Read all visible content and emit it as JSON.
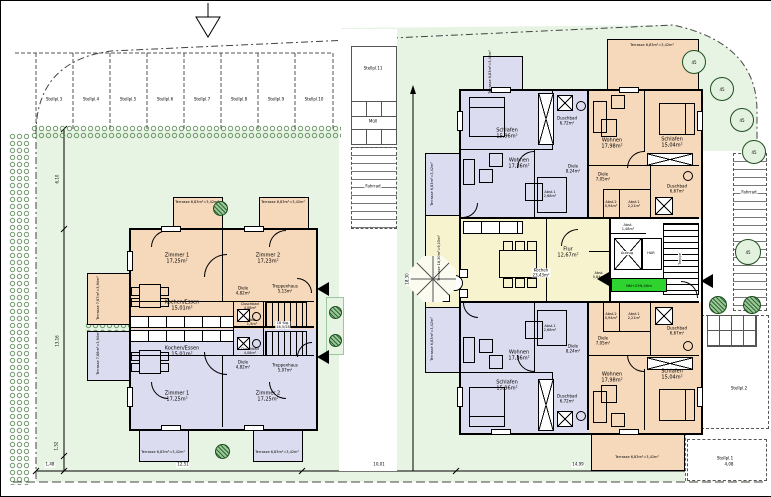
{
  "site": {
    "parking_row": [
      "Stellpl.3",
      "Stellpl.4",
      "Stellpl.5",
      "Stellpl.6",
      "Stellpl.7",
      "Stellpl.8",
      "Stellpl.9",
      "Stellpl.10"
    ],
    "stellpl11": "Stellpl.11",
    "stellpl2": "Stellpl.2",
    "stellpl1": "Stellpl.1",
    "muell": "Müll",
    "fahrrad_left": "Fahrrad",
    "fahrrad_right": "Fahrrad",
    "tree_label": "45",
    "elevation": "NN+259,40m"
  },
  "dims": {
    "b1": "1,48",
    "b2": "12,51",
    "b3": "10,01",
    "b4": "14,99",
    "b5": "4,08",
    "l1": "6,10",
    "l2": "13,16",
    "l3": "1,52",
    "m1": "18,30"
  },
  "house1": {
    "upper": {
      "zimmer1": "Zimmer 1\n17,25m²",
      "zimmer2": "Zimmer 2\n17,23m²",
      "kochen": "Kochen/Essen\n15,01m²",
      "diele": "Diele\n4,82m²",
      "duschbad": "Duschbad\n4,08m²",
      "treppenhaus": "Treppenhaus\n5,13m²",
      "abst": "Abst.\n1,5m²",
      "stair_note": "18 Stg.\n18,5/28",
      "terrasse": "Terrasse 6,83m²=3,42m²",
      "terrasse_seite": "Terrasse 7,87m²=3,94m²"
    },
    "lower": {
      "zimmer1": "Zimmer 1\n17,25m²",
      "zimmer2": "Zimmer 2\n17,25m²",
      "kochen": "Kochen/Essen\n15,01m²",
      "diele": "Diele\n4,82m²",
      "duschbad": "Duschbad\n4,08m²",
      "treppenhaus": "Treppenhaus\n5,07m²",
      "terrasse": "Terrasse 6,83m²=3,42m²",
      "terrasse_seite": "Terrasse 7,88m²=3,94m²"
    }
  },
  "house2": {
    "apt_tl": {
      "schlafen": "Schlafen\n15,96m²",
      "duschbad": "Duschbad\n6,72m²",
      "wohnen": "Wohnen\n17,36m²",
      "diele": "Diele\n8,24m²",
      "abst1": "Abst.1\n2,68m²",
      "terrasse": "Terrasse 6,83m²=3,42m²"
    },
    "apt_tr": {
      "wohnen": "Wohnen\n17,98m²",
      "schlafen": "Schlafen\n15,04m²",
      "diele": "Diele\n7,05m²",
      "duschbad": "Duschbad\n6,67m²",
      "abst1": "Abst.1\n2,21m²",
      "abst2": "Abst.2\n0,94m²",
      "terrasse": "Terrasse 6,83m²=3,42m²"
    },
    "apt_bl": {
      "schlafen": "Schlafen\n15,96m²",
      "duschbad": "Duschbad\n6,72m²",
      "wohnen": "Wohnen\n17,36m²",
      "diele": "Diele\n8,24m²",
      "abst1": "Abst.1\n2,68m²",
      "terrasse": "Terrasse 6,83m²=3,42m²"
    },
    "apt_br": {
      "wohnen": "Wohnen\n17,98m²",
      "schlafen": "Schlafen\n15,04m²",
      "diele": "Diele\n7,05m²",
      "duschbad": "Duschbad\n6,67m²",
      "abst1": "Abst.1\n2,21m²",
      "abst2": "Abst.2\n0,94m²",
      "terrasse": "Terrasse 6,83m²=3,42m²"
    },
    "common": {
      "kochen": "Kochen\n23,43m²",
      "flur": "Flur\n12,67m²",
      "abst_gross": "Abst.\n5,84m²",
      "abst_klein": "Abst.\n1,48m²",
      "aufzug": "Aufzug",
      "har": "HAR",
      "treppe": "Treppe",
      "terrasse_gross": "Terrasse 18,30m²=9,15m²"
    }
  }
}
